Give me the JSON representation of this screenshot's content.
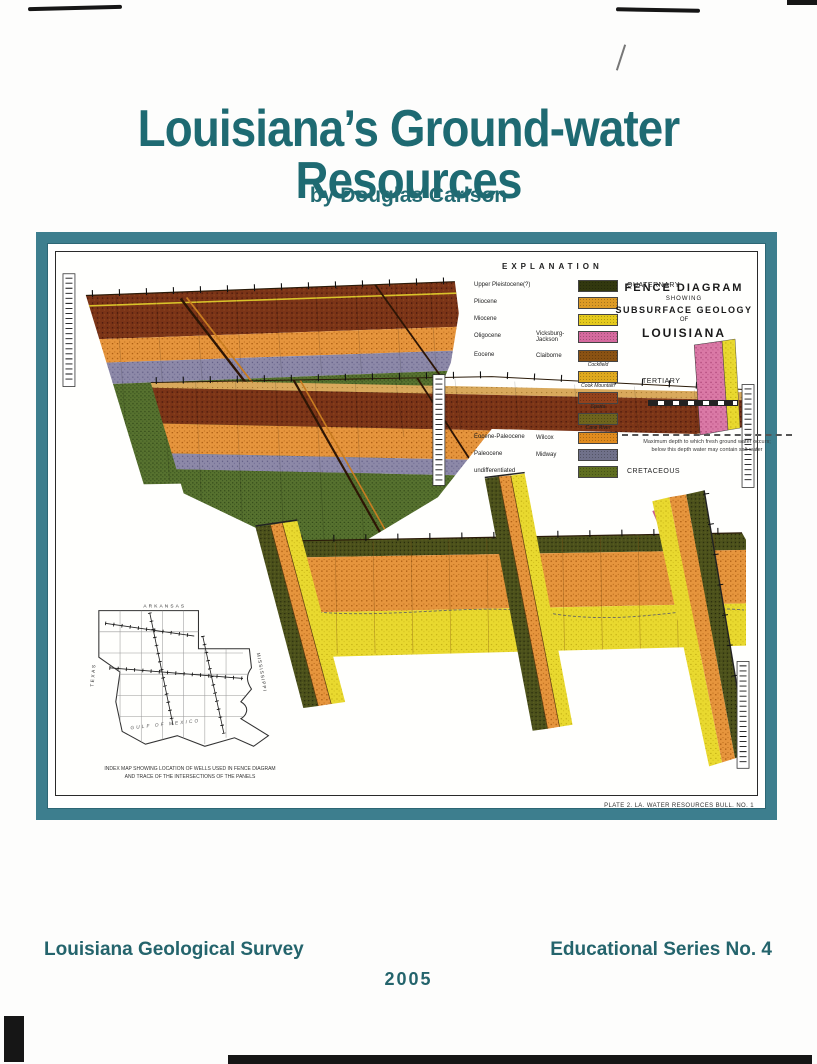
{
  "page": {
    "title": "Louisiana’s Ground-water Resources",
    "byline": "by Douglas Carlson",
    "footer_left": "Louisiana Geological Survey",
    "footer_right": "Educational Series No. 4",
    "footer_year": "2005"
  },
  "colors": {
    "accent_teal": "#1e6a72",
    "frame_teal": "#3d7e8e"
  },
  "plate": {
    "caption": "PLATE 2.  LA. WATER RESOURCES BULL. NO. 1",
    "diagram_title": {
      "line1": "FENCE DIAGRAM",
      "line2": "SHOWING",
      "line3": "SUBSURFACE GEOLOGY",
      "line4": "OF",
      "line5": "LOUISIANA"
    },
    "depth_note": {
      "line1": "Maximum depth to which fresh ground water occurs;",
      "line2": "below this depth water may contain salt water"
    },
    "legend": {
      "title": "EXPLANATION",
      "tertiary_label": "TERTIARY",
      "rows": [
        {
          "epoch": "Upper Pleistocene(?)",
          "group": "",
          "unit": "",
          "color": "#32380f",
          "era": "QUATERNARY"
        },
        {
          "epoch": "Pliocene",
          "group": "",
          "unit": "",
          "color": "#dd9b25"
        },
        {
          "epoch": "Miocene",
          "group": "",
          "unit": "",
          "color": "#e5ca1d"
        },
        {
          "epoch": "Oligocene",
          "group": "Vicksburg-Jackson",
          "unit": "",
          "color": "#d56a9e"
        },
        {
          "epoch": "Eocene",
          "group": "Claiborne",
          "unit": "Cockfield",
          "color": "#8a5213"
        },
        {
          "epoch": "",
          "group": "",
          "unit": "Cook Mountain",
          "color": "#dfa91e"
        },
        {
          "epoch": "",
          "group": "",
          "unit": "Sparta",
          "color": "#93421c"
        },
        {
          "epoch": "",
          "group": "",
          "unit": "Cane River",
          "color": "#6e641d"
        },
        {
          "epoch": "Eocene-Paleocene",
          "group": "Wilcox",
          "unit": "",
          "color": "#e08b1e"
        },
        {
          "epoch": "Paleocene",
          "group": "Midway",
          "unit": "",
          "color": "#70718a"
        },
        {
          "epoch": "undifferentiated",
          "group": "",
          "unit": "",
          "color": "#5f6e20",
          "era": "CRETACEOUS"
        }
      ]
    },
    "index_map": {
      "label_north": "ARKANSAS",
      "label_west": "TEXAS",
      "label_east": "MISSISSIPPI",
      "label_gulf": "GULF OF MEXICO",
      "caption_line1": "INDEX MAP SHOWING LOCATION OF WELLS USED IN FENCE DIAGRAM",
      "caption_line2": "AND TRACE OF THE INTERSECTIONS OF THE PANELS"
    }
  }
}
